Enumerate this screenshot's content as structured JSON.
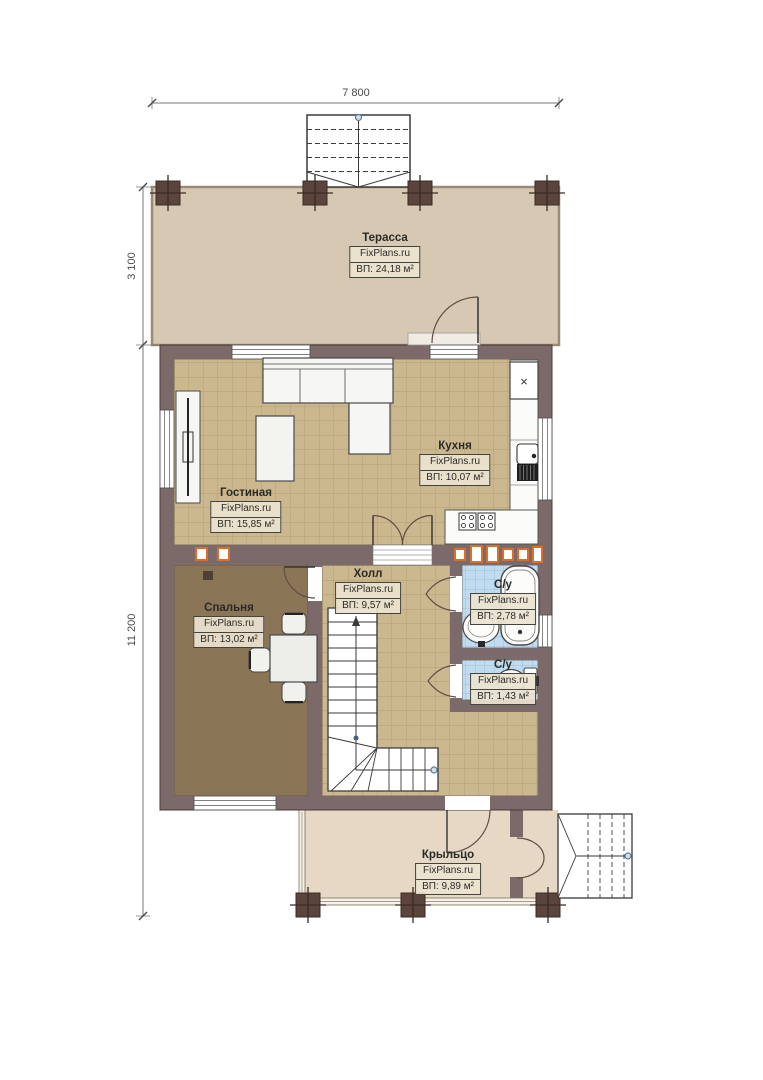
{
  "plan": {
    "watermark": "FixPlans.ru",
    "dimensions": {
      "top": "7 800",
      "left_upper": "3 100",
      "left_lower": "11 200"
    },
    "rooms": [
      {
        "id": "terrace",
        "name": "Терасса",
        "area": "ВП: 24,18 м²"
      },
      {
        "id": "living",
        "name": "Гостиная",
        "area": "ВП: 15,85 м²"
      },
      {
        "id": "kitchen",
        "name": "Кухня",
        "area": "ВП: 10,07 м²"
      },
      {
        "id": "hall",
        "name": "Холл",
        "area": "ВП: 9,57 м²"
      },
      {
        "id": "bedroom",
        "name": "Спальня",
        "area": "ВП: 13,02 м²"
      },
      {
        "id": "bathroom-1",
        "name": "С/у",
        "area": "ВП: 2,78 м²"
      },
      {
        "id": "bathroom-2",
        "name": "С/у",
        "area": "ВП: 1,43 м²"
      },
      {
        "id": "porch",
        "name": "Крыльцо",
        "area": "ВП: 9,89 м²"
      }
    ],
    "symbols": {
      "fridge": "×"
    },
    "colors": {
      "background": "#ffffff",
      "wall": "#7b6a69",
      "terrace_floor": "#d7c8b4",
      "tile_floor": "#ccb88f",
      "tile_line": "#b19c75",
      "bedroom_floor": "#8a7557",
      "bath_floor": "#c0dcee",
      "bath_tile_line": "#8fb9d6",
      "porch_floor": "#e6d8c5",
      "column": "#5a443c",
      "vent_marker": "#d96f2b",
      "label_bg": "#ece3d0",
      "dimension_text": "#4a4a4a"
    }
  }
}
